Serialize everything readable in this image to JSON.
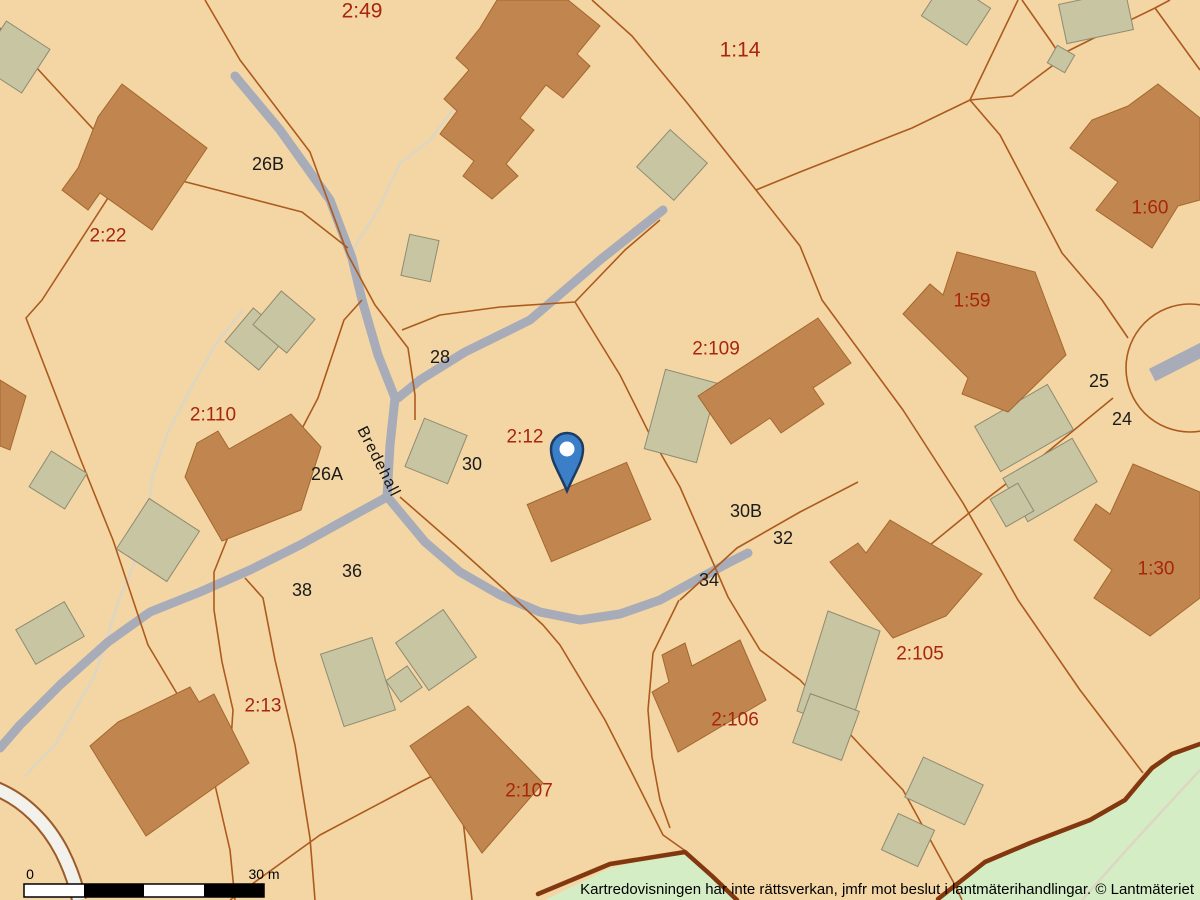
{
  "map": {
    "type": "cadastral-map",
    "colors": {
      "background": "#f3d6a3",
      "residential_building": "#c1854f",
      "residential_border": "#a5672c",
      "outbuilding": "#c8c5a3",
      "outbuilding_border": "#8e8b72",
      "road": "#a7acb8",
      "footpath": "#dcd6c2",
      "white_road": "#f2f1ec",
      "white_road_border": "#9c5b28",
      "parcel_boundary": "#ad5a1e",
      "greenery": "#d5edc5",
      "greenery_edge_path": "#82370e",
      "parcel_label": "#a8250e",
      "address_label": "#1b1b1b",
      "marker_blue": "#3a7fc8",
      "marker_outline": "#1d3c63"
    },
    "parcel_labels": [
      {
        "text": "2:49",
        "x": 362,
        "y": 11,
        "size": 21
      },
      {
        "text": "1:14",
        "x": 740,
        "y": 50,
        "size": 21
      },
      {
        "text": "2:22",
        "x": 108,
        "y": 236
      },
      {
        "text": "1:60",
        "x": 1150,
        "y": 208
      },
      {
        "text": "1:59",
        "x": 972,
        "y": 301
      },
      {
        "text": "2:110",
        "x": 213,
        "y": 415
      },
      {
        "text": "2:109",
        "x": 716,
        "y": 349
      },
      {
        "text": "2:12",
        "x": 525,
        "y": 437
      },
      {
        "text": "1:30",
        "x": 1156,
        "y": 569
      },
      {
        "text": "2:105",
        "x": 920,
        "y": 654
      },
      {
        "text": "2:13",
        "x": 263,
        "y": 706
      },
      {
        "text": "2:106",
        "x": 735,
        "y": 720
      },
      {
        "text": "2:107",
        "x": 529,
        "y": 791
      }
    ],
    "address_labels": [
      {
        "text": "26B",
        "x": 268,
        "y": 164
      },
      {
        "text": "28",
        "x": 440,
        "y": 357
      },
      {
        "text": "30",
        "x": 472,
        "y": 464
      },
      {
        "text": "26A",
        "x": 327,
        "y": 474
      },
      {
        "text": "36",
        "x": 352,
        "y": 571
      },
      {
        "text": "38",
        "x": 302,
        "y": 590
      },
      {
        "text": "30B",
        "x": 746,
        "y": 511
      },
      {
        "text": "32",
        "x": 783,
        "y": 538
      },
      {
        "text": "34",
        "x": 709,
        "y": 580
      },
      {
        "text": "25",
        "x": 1099,
        "y": 381
      },
      {
        "text": "24",
        "x": 1122,
        "y": 419
      }
    ],
    "street_label": {
      "text": "Bredehall",
      "x": 378,
      "y": 462,
      "rotation": 63
    },
    "marker": {
      "name": "location-pin",
      "x": 567,
      "y": 491,
      "parcel": "2:12"
    },
    "scale_bar": {
      "start_label": "0",
      "end_label": "30 m"
    },
    "disclaimer": "Kartredovisningen har inte rättsverkan, jmfr mot beslut i lantmäterihandlingar. © Lantmäteriet"
  }
}
